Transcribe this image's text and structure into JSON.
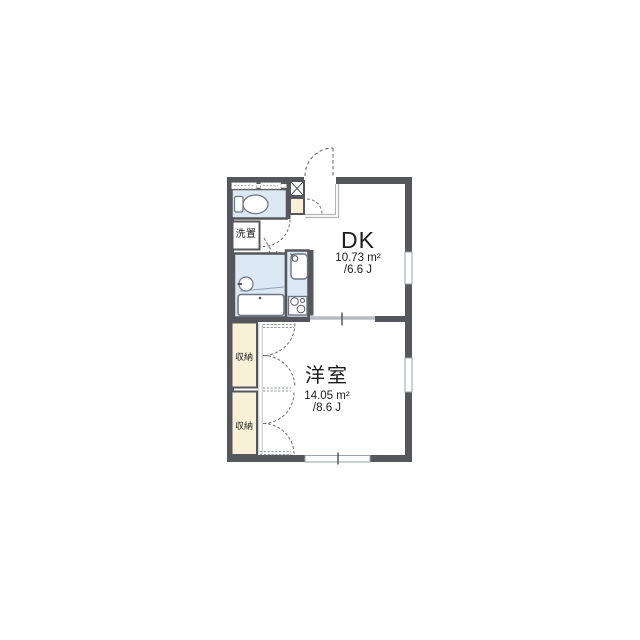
{
  "document": {
    "type": "apartment-floor-plan",
    "background": "#ffffff"
  },
  "rooms": {
    "dk": {
      "name": "DK",
      "area_sqm": "10.73 m²",
      "area_jo": "/6.6 J"
    },
    "western": {
      "name": "洋室",
      "area_sqm": "14.05 m²",
      "area_jo": "/8.6 J"
    },
    "laundry": {
      "label": "洗置"
    },
    "closet_top": {
      "label": "収納"
    },
    "closet_bottom": {
      "label": "収納"
    }
  },
  "fixtures": [
    "toilet-icon",
    "toilet-tank-icon",
    "washing-machine-space",
    "bathtub-icon",
    "washbasin-icon",
    "kitchen-sink-icon",
    "faucet-icon",
    "stove-burners-icon",
    "shoe-cabinet-x-icon",
    "entrance-step",
    "entrance-door-swing",
    "interior-door-swing",
    "closet-double-door-swing",
    "sliding-door",
    "window-band"
  ],
  "colors": {
    "wall": "#55575c",
    "wet_room_fill": "#dce9f5",
    "closet_fill": "#f9f0d8",
    "fixture_stroke": "#6b7684",
    "door_dash": "#6e6e6e",
    "step_line": "#b4b4b4",
    "window_frame": "#9aa2ab",
    "hatch": "#8f959c",
    "text": "#1d1d1f"
  }
}
